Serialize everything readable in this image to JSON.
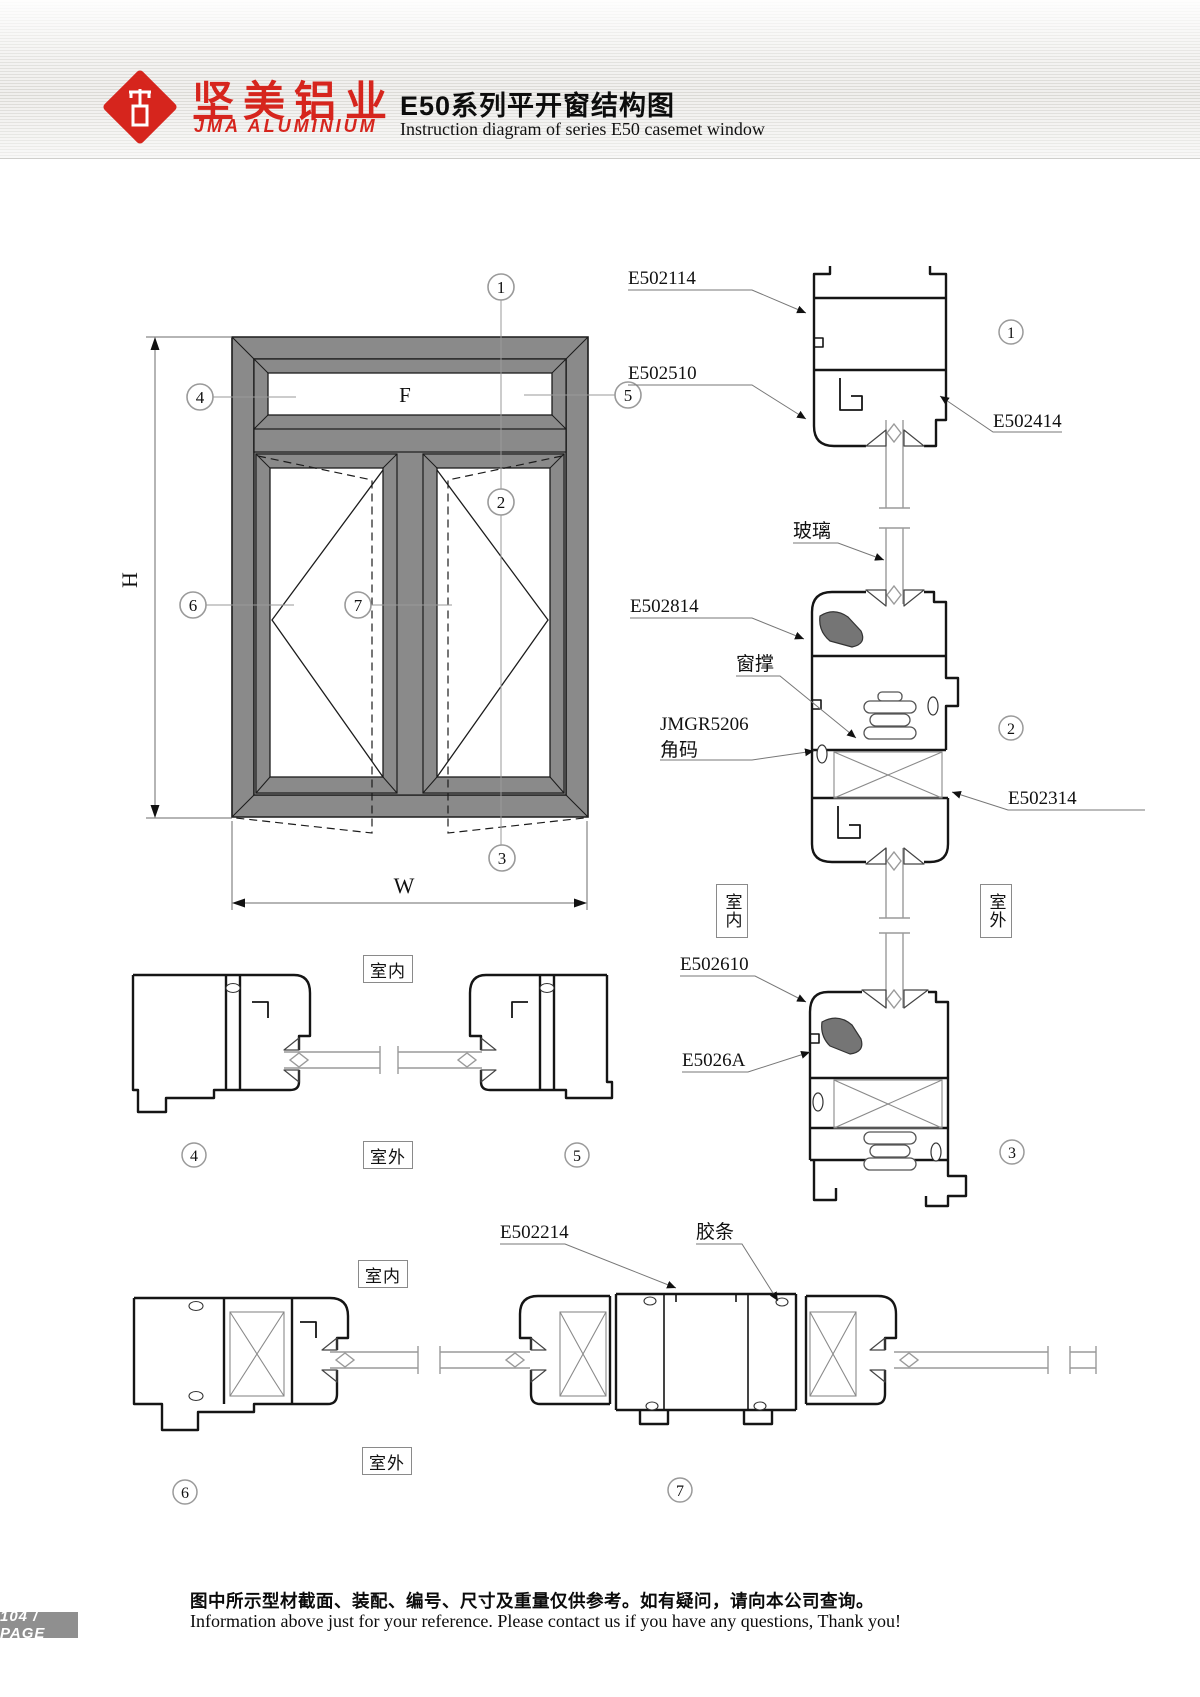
{
  "colors": {
    "accent": "#d6251d",
    "frame_gray": "#8a8a8a"
  },
  "header": {
    "brand_cn": "坚美铝业",
    "brand_en": "JMA ALUMINIUM",
    "title_cn": "E50系列平开窗结构图",
    "title_en": "Instruction diagram of series E50 casemet window"
  },
  "elevation": {
    "f": "F",
    "h": "H",
    "w": "W"
  },
  "callouts": {
    "c1": "1",
    "c2": "2",
    "c3": "3",
    "c4": "4",
    "c5": "5",
    "c6": "6",
    "c7": "7"
  },
  "labels": {
    "e502114": "E502114",
    "e502510": "E502510",
    "e502414": "E502414",
    "glass": "玻璃",
    "e502814": "E502814",
    "stay": "窗撑",
    "jmgr": "JMGR5206",
    "corner": "角码",
    "e502314": "E502314",
    "e502610": "E502610",
    "e5026a": "E5026A",
    "e502214": "E502214",
    "gasket": "胶条"
  },
  "rooms": {
    "indoor": "室内",
    "outdoor": "室外"
  },
  "footer": {
    "page_badge": "104 / PAGE",
    "note_cn": "图中所示型材截面、装配、编号、尺寸及重量仅供参考。如有疑问，请向本公司查询。",
    "note_en": "Information above just for your reference. Please contact us if you have any questions, Thank you!"
  }
}
